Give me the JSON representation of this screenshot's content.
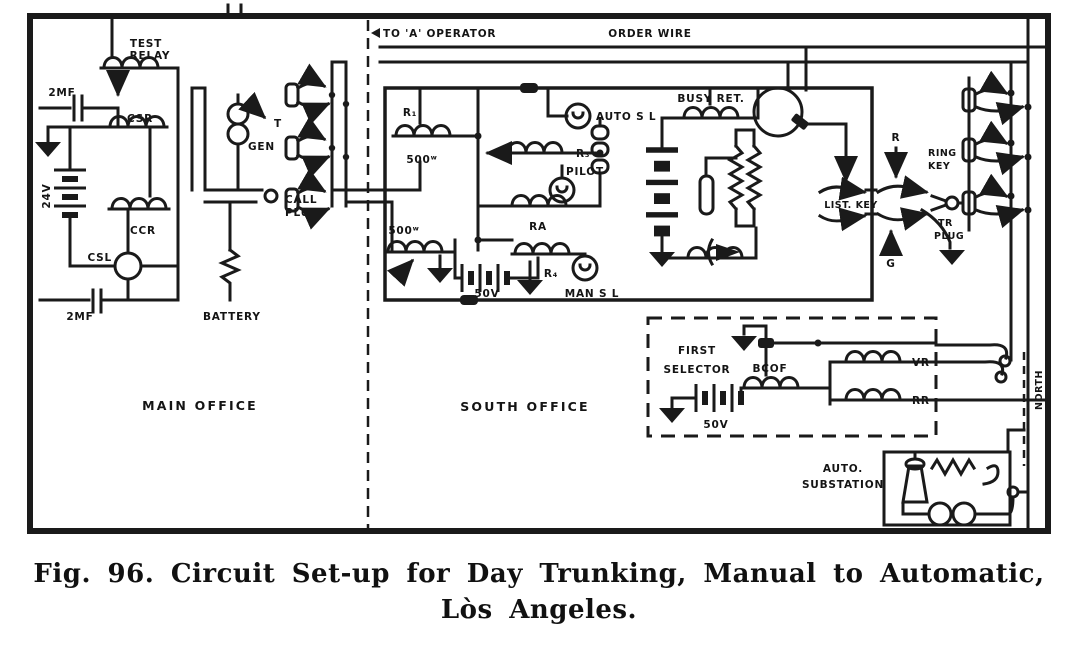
{
  "caption": {
    "line1": "Fig. 96.  Circuit Set-up for Day Trunking, Manual to Automatic,",
    "line2": "Lòs Angeles."
  },
  "regions": {
    "main_office": "MAIN OFFICE",
    "south_office": "SOUTH OFFICE",
    "north": "NORTH"
  },
  "top": {
    "to_a_operator": "TO 'A' OPERATOR",
    "order_wire": "ORDER WIRE"
  },
  "main": {
    "test_relay1": "TEST",
    "test_relay2": "RELAY",
    "cap_top": "2MF",
    "csr": "CSR",
    "v24": "24V",
    "ccr": "CCR",
    "csl": "CSL",
    "cap_bot": "2MF",
    "gen": "GEN",
    "t": "T",
    "call1": "CALL",
    "call2": "PLUG",
    "battery": "BATTERY"
  },
  "south": {
    "r1": "R₁",
    "r1_ohms": "500ʷ",
    "r2_ohms": "500ʷ",
    "r3": "R₃",
    "ra": "RA",
    "r4": "R₄",
    "pilot": "PILOT",
    "auto_sl": "AUTO S L",
    "man_sl": "MAN S L",
    "v50": "50V",
    "busy_ret": "BUSY RET.",
    "list_key": "LIST. KEY"
  },
  "trunk": {
    "ring1": "RING",
    "ring2": "KEY",
    "r": "R",
    "g": "G",
    "tr1": "TR",
    "tr2": "PLUG"
  },
  "selector": {
    "line1": "FIRST",
    "line2": "SELECTOR",
    "bcof": "BCOF",
    "v50": "50V",
    "vr": "VR",
    "rr": "RR"
  },
  "substation": {
    "line1": "AUTO.",
    "line2": "SUBSTATION"
  },
  "colors": {
    "ink": "#1a1a1a",
    "paper": "#ffffff"
  }
}
